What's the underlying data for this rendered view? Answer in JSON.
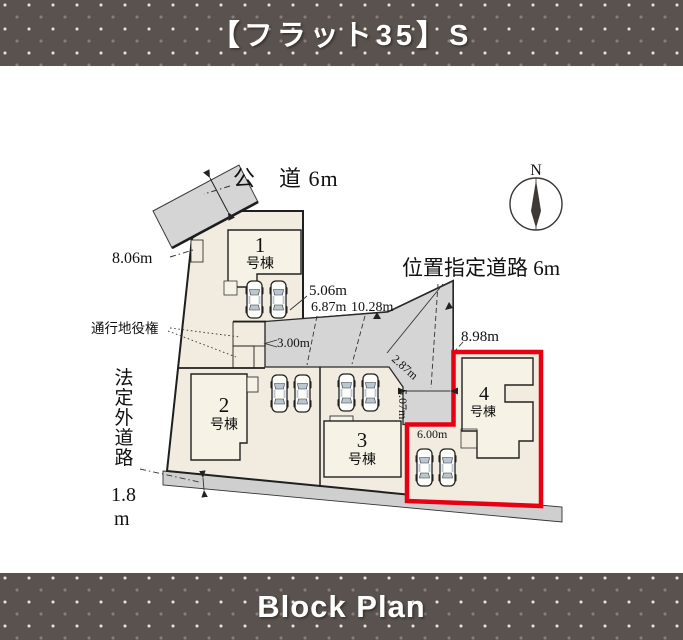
{
  "banner_top": {
    "title": "【フラット35】S"
  },
  "banner_bottom": {
    "title": "Block Plan"
  },
  "plan": {
    "north_label": "N",
    "roads": {
      "public_road": "公　道 6m",
      "designated_road": "位置指定道路 6m",
      "statutory_road": "法定外道路",
      "statutory_width": "1.8",
      "statutory_width_unit": "m",
      "easement": "通行地役権"
    },
    "dimensions": {
      "d806": "8.06m",
      "d506": "5.06m",
      "d687": "6.87m",
      "d1028": "10.28m",
      "d300": "3.00m",
      "d287": "2.87m",
      "d507": "5.07m",
      "d898": "8.98m",
      "d600": "6.00m"
    },
    "buildings": [
      {
        "no": "1",
        "suffix": "号棟"
      },
      {
        "no": "2",
        "suffix": "号棟"
      },
      {
        "no": "3",
        "suffix": "号棟"
      },
      {
        "no": "4",
        "suffix": "号棟"
      }
    ],
    "colors": {
      "lot_fill": "#f1ecdf",
      "building_fill": "#f6f2e6",
      "road_fill": "#d5d5d5",
      "bottom_road_fill": "#cfcfcf",
      "highlight_red": "#e60012",
      "building_text": "#943b28",
      "banner_bg": "#59524e"
    }
  }
}
